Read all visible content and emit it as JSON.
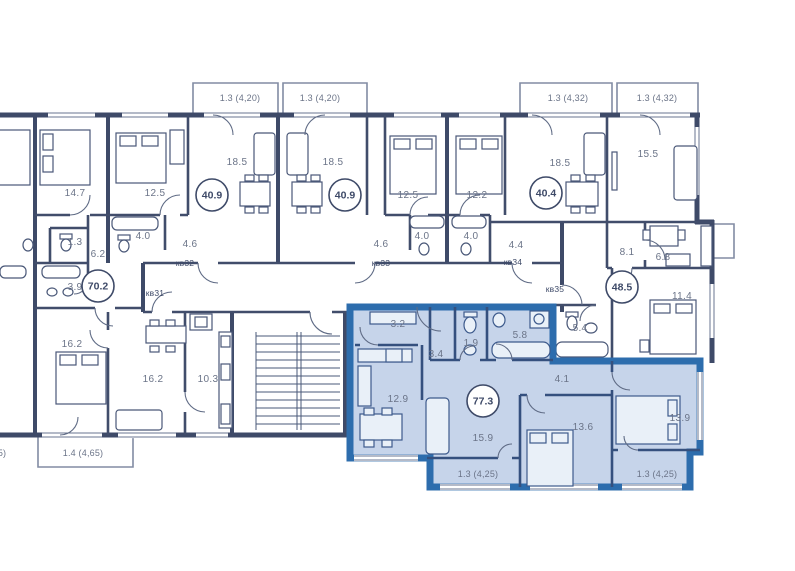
{
  "plan": {
    "background": "#ffffff",
    "wall_color": "#3e4a68",
    "highlight_border": "#2d6dad",
    "highlight_fill": "#c6d4ea",
    "highlighted_unit_total": "77.3"
  },
  "rooms": [
    {
      "t": "14.7",
      "x": 75,
      "y": 196
    },
    {
      "t": "12.5",
      "x": 155,
      "y": 196
    },
    {
      "t": "18.5",
      "x": 237,
      "y": 165
    },
    {
      "t": "18.5",
      "x": 333,
      "y": 165
    },
    {
      "t": "12.5",
      "x": 408,
      "y": 198
    },
    {
      "t": "12.2",
      "x": 477,
      "y": 198
    },
    {
      "t": "18.5",
      "x": 560,
      "y": 166
    },
    {
      "t": "15.5",
      "x": 648,
      "y": 157
    },
    {
      "t": "1.3",
      "x": 75,
      "y": 245
    },
    {
      "t": "6.2",
      "x": 98,
      "y": 257
    },
    {
      "t": "3.9",
      "x": 75,
      "y": 290
    },
    {
      "t": "4.0",
      "x": 143,
      "y": 239
    },
    {
      "t": "4.6",
      "x": 190,
      "y": 247
    },
    {
      "t": "4.6",
      "x": 381,
      "y": 247
    },
    {
      "t": "4.0",
      "x": 422,
      "y": 239
    },
    {
      "t": "4.0",
      "x": 471,
      "y": 239
    },
    {
      "t": "4.4",
      "x": 516,
      "y": 248
    },
    {
      "t": "8.1",
      "x": 627,
      "y": 255
    },
    {
      "t": "6.8",
      "x": 663,
      "y": 260
    },
    {
      "t": "11.4",
      "x": 682,
      "y": 299
    },
    {
      "t": "5.4",
      "x": 580,
      "y": 331
    },
    {
      "t": "16.2",
      "x": 72,
      "y": 347
    },
    {
      "t": "16.2",
      "x": 153,
      "y": 382
    },
    {
      "t": "10.3",
      "x": 208,
      "y": 382
    },
    {
      "t": "3.2",
      "x": 398,
      "y": 327
    },
    {
      "t": "3.4",
      "x": 436,
      "y": 357
    },
    {
      "t": "1.9",
      "x": 471,
      "y": 346
    },
    {
      "t": "5.8",
      "x": 520,
      "y": 338
    },
    {
      "t": "12.9",
      "x": 398,
      "y": 402
    },
    {
      "t": "15.9",
      "x": 483,
      "y": 441
    },
    {
      "t": "4.1",
      "x": 562,
      "y": 382
    },
    {
      "t": "13.6",
      "x": 583,
      "y": 430
    },
    {
      "t": "13.9",
      "x": 680,
      "y": 421
    },
    {
      "t": "14.7",
      "x": -10,
      "y": 196
    },
    {
      "t": "1.3",
      "x": -7,
      "y": 245
    },
    {
      "t": "3.9",
      "x": -7,
      "y": 290
    },
    {
      "t": "16.2",
      "x": -10,
      "y": 347
    }
  ],
  "balconies": [
    {
      "t": "1.3 (4,20)",
      "x": 240,
      "y": 101
    },
    {
      "t": "1.3 (4,20)",
      "x": 320,
      "y": 101
    },
    {
      "t": "1.3 (4,32)",
      "x": 568,
      "y": 101
    },
    {
      "t": "1.3 (4,32)",
      "x": 657,
      "y": 101
    },
    {
      "t": "1.4 (4,65)",
      "x": 83,
      "y": 456
    },
    {
      "t": "1.4 (4,65)",
      "x": -14,
      "y": 456
    },
    {
      "t": "1.3 (4,25)",
      "x": 478,
      "y": 477
    },
    {
      "t": "1.3 (4,25)",
      "x": 657,
      "y": 477
    }
  ],
  "kv_labels": [
    {
      "t": "кв31",
      "x": 155,
      "y": 296
    },
    {
      "t": "кв32",
      "x": 185,
      "y": 266
    },
    {
      "t": "кв33",
      "x": 381,
      "y": 266
    },
    {
      "t": "кв34",
      "x": 513,
      "y": 265
    },
    {
      "t": "кв35",
      "x": 555,
      "y": 292
    }
  ],
  "badges": [
    {
      "t": "70.2",
      "x": 98,
      "y": 286
    },
    {
      "t": "40.9",
      "x": 212,
      "y": 195
    },
    {
      "t": "40.9",
      "x": 345,
      "y": 195
    },
    {
      "t": "40.4",
      "x": 546,
      "y": 193
    },
    {
      "t": "48.5",
      "x": 622,
      "y": 287
    },
    {
      "t": "77.3",
      "x": 483,
      "y": 401
    }
  ]
}
